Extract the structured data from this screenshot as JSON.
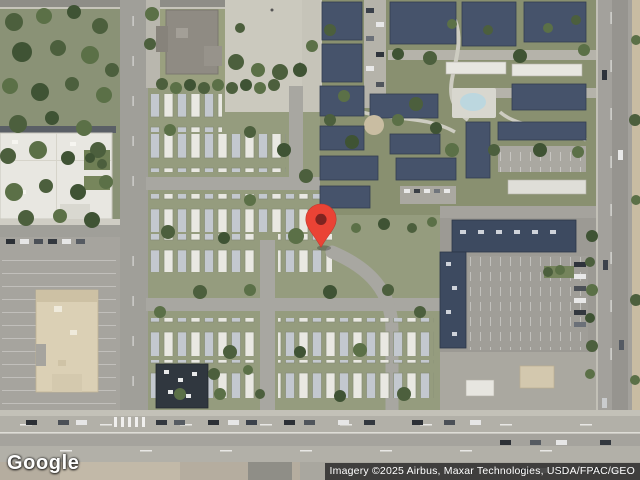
{
  "map": {
    "view": "satellite",
    "marker": {
      "icon": "map-pin",
      "color": "#EA4335",
      "inner_color": "#7E2420"
    },
    "logo": {
      "text": "Google"
    },
    "attribution": {
      "text": "Imagery ©2025 Airbus, Maxar Technologies, USDA/FPAC/GEO",
      "bg": "#242424",
      "text_color": "#ffffff"
    }
  }
}
